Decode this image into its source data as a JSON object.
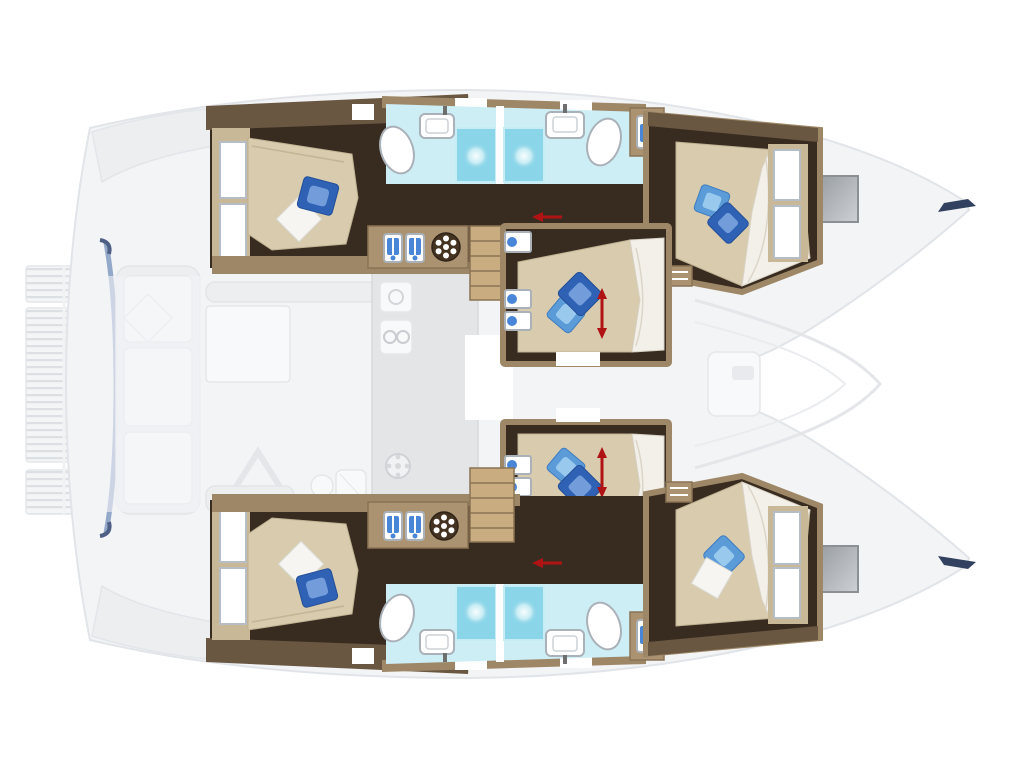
{
  "diagram": {
    "type": "boat-floorplan",
    "vessel": "catamaran",
    "view": "top-down deck layout, interior accommodations highlighted, exterior decks faded",
    "rooms": {
      "port_hull": {
        "aft_cabin": {
          "beds": 1,
          "pillows": [
            "blue",
            "white"
          ],
          "windows": 2
        },
        "bathroom": {
          "showers": 2,
          "toilets": 2,
          "sinks": 2
        },
        "fore_cabin": {
          "beds": 1,
          "pillows": [
            "light-blue",
            "blue"
          ],
          "windows": 2
        }
      },
      "center": {
        "mid_cabin_fwd": {
          "beds": 1,
          "pillows": [
            "blue",
            "light-blue"
          ],
          "dimension_arrow": true,
          "shelves": 3
        },
        "mid_cabin_aft": {
          "beds": 1,
          "pillows": [
            "light-blue",
            "blue"
          ],
          "dimension_arrow": true,
          "shelves": 3
        }
      },
      "starboard_hull": {
        "aft_cabin": {
          "beds": 1,
          "pillows": [
            "white",
            "blue"
          ],
          "windows": 2
        },
        "bathroom": {
          "showers": 2,
          "toilets": 2,
          "sinks": 2
        },
        "fore_cabin": {
          "beds": 1,
          "pillows": [
            "light-blue",
            "white"
          ],
          "windows": 2
        }
      },
      "faded_areas": [
        "aft swim platform",
        "cockpit",
        "saloon with table",
        "galley strip",
        "foredeck lounge",
        "bow trampolines"
      ]
    },
    "icons": [
      "ship-wheel-vent-icon",
      "washer-locker-icon",
      "shower-jet-icon",
      "toilet-icon",
      "sink-icon",
      "shelf-cubby-icon",
      "bow-hatch-icon",
      "dimension-arrow-icon",
      "stairs-icon"
    ],
    "stairs": 2,
    "dimension_arrows": {
      "vertical_double": 2,
      "horizontal_single": 2
    }
  },
  "colors": {
    "background": "#ffffff",
    "hull_faded": "#f3f4f6",
    "hull_outline": "#e1e4e8",
    "transom_accent": "#8aa0c4",
    "transom_accent_dark": "#4d5f85",
    "wall_tan": "#9d8767",
    "wall_light": "#c9b897",
    "wall_dark": "#6a5741",
    "floor_dark": "#382c21",
    "floor_deep": "#241c15",
    "bed": "#d8cbae",
    "duvet": "#f3f0ea",
    "pillow_blue": "#2f62b5",
    "pillow_blue_light": "#5b9bd8",
    "pillow_white": "#f6f5f1",
    "bathroom_floor": "#cdeef5",
    "shower": "#8bd5e8",
    "fixture_white": "#ffffff",
    "fixture_outline": "#aab1b8",
    "steps_wood": "#c9ad80",
    "steps_line": "#8a7354",
    "cabinet_tan": "#ab9372",
    "icon_blue": "#4a86d8",
    "wheel_dark": "#453322",
    "hatch_gray": "#a8a8a8",
    "bow_tip_navy": "#31415f",
    "arrow_red": "#b01313"
  }
}
